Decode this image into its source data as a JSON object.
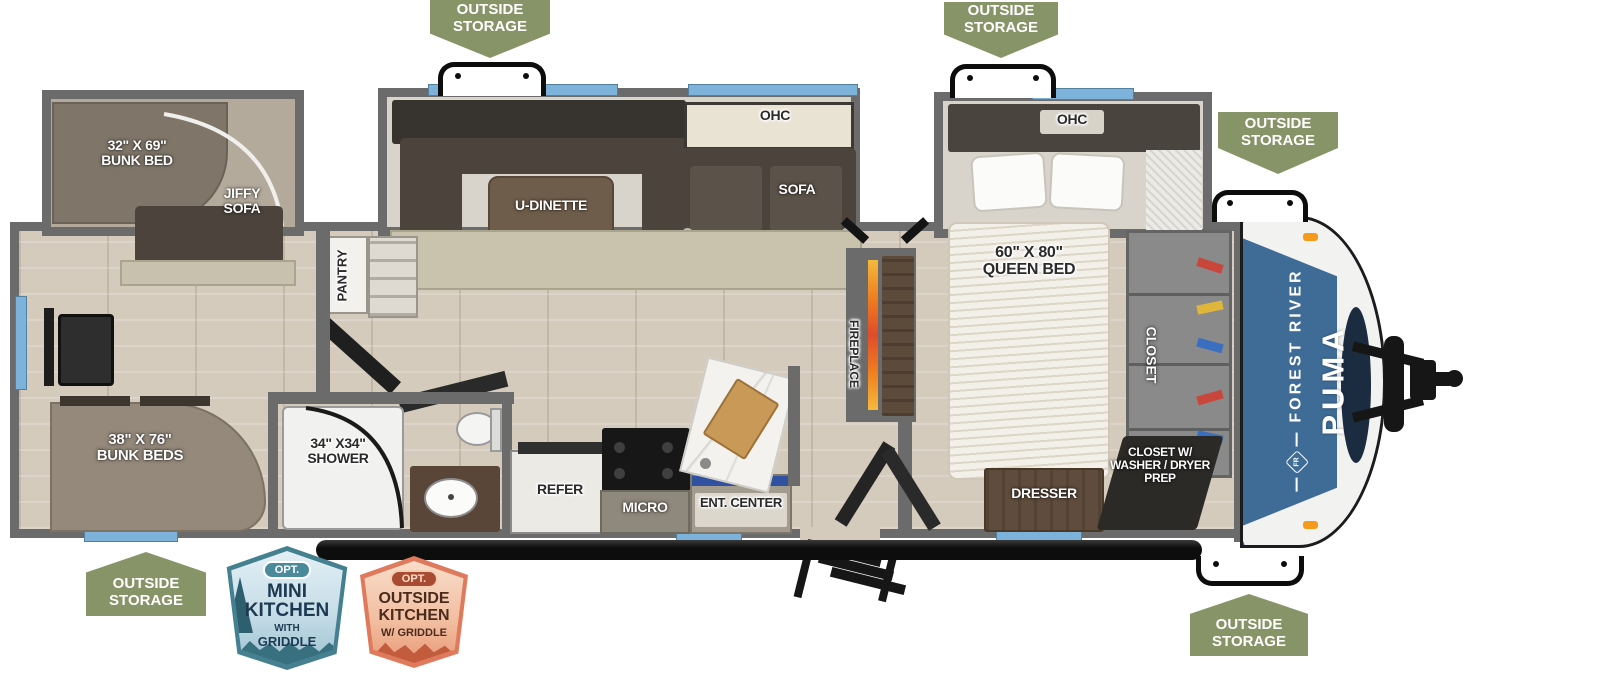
{
  "labels": {
    "outside_storage": "OUTSIDE STORAGE",
    "pantry": "PANTRY",
    "u_dinette": "U-DINETTE",
    "ohc": "OHC",
    "sofa": "SOFA",
    "fireplace": "FIREPLACE",
    "jiffy_sofa": "JIFFY SOFA",
    "closet": "CLOSET",
    "refer": "REFER",
    "micro": "MICRO",
    "ent_center": "ENT. CENTER",
    "dresser": "DRESSER",
    "closet_wd": "CLOSET W/ WASHER / DRYER PREP"
  },
  "dimensions": {
    "bunk_slide": {
      "size": "32\" X 69\"",
      "name": "BUNK BED"
    },
    "queen": {
      "size": "60\" X 80\"",
      "name": "QUEEN BED"
    },
    "bunks": {
      "size": "38\" X 76\"",
      "name": "BUNK BEDS"
    },
    "shower": {
      "size": "34\" X34\"",
      "name": "SHOWER"
    }
  },
  "brand": {
    "maker": "FOREST RIVER",
    "model": "PUMA",
    "logo": "FR"
  },
  "options": {
    "mini_kitchen": {
      "opt": "OPT.",
      "line1": "MINI",
      "line2": "KITCHEN",
      "line3": "WITH",
      "line4": "GRIDDLE"
    },
    "outside_kitchen": {
      "opt": "OPT.",
      "line1": "OUTSIDE",
      "line2": "KITCHEN",
      "line3": "W/ GRIDDLE"
    }
  },
  "colors": {
    "badge_green": "#879468",
    "wall_gray": "#6b6b6b",
    "window_blue": "#7db3da",
    "cap_blue": "#3f6c97",
    "cap_navy": "#1c2c40",
    "fireplace_orange": "#f39c12",
    "mini_teal": "#44808f",
    "outside_salmon": "#df7a5c"
  }
}
